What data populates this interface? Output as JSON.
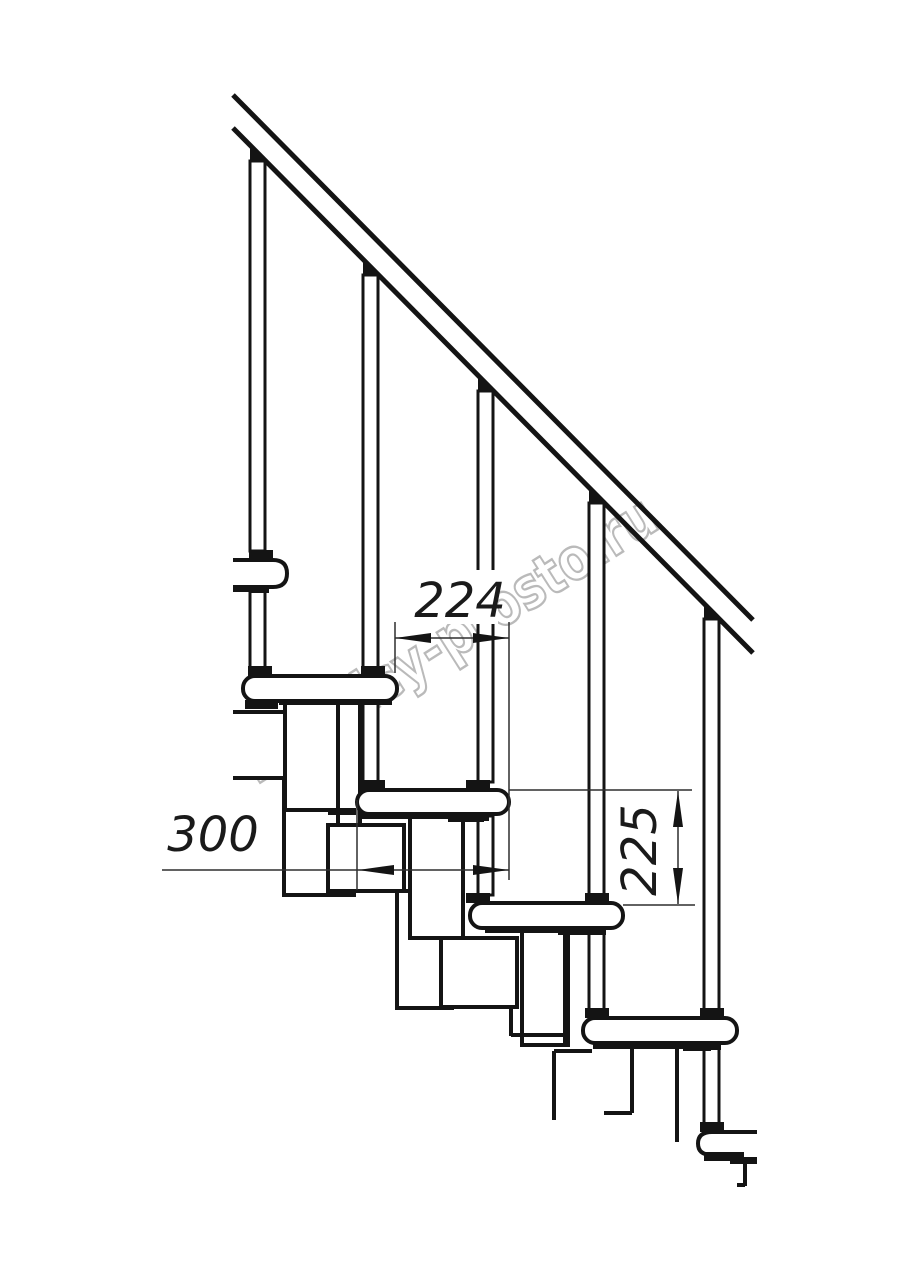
{
  "drawing": {
    "colors": {
      "background": "#ffffff",
      "main_line": "#141414",
      "thin_line": "#2f2f2f",
      "watermark": "#a9a9a9"
    },
    "dimensions": {
      "going": "224",
      "tread_depth": "300",
      "rise": "225"
    },
    "watermark_text": "lestnicy-prosto.ru"
  }
}
